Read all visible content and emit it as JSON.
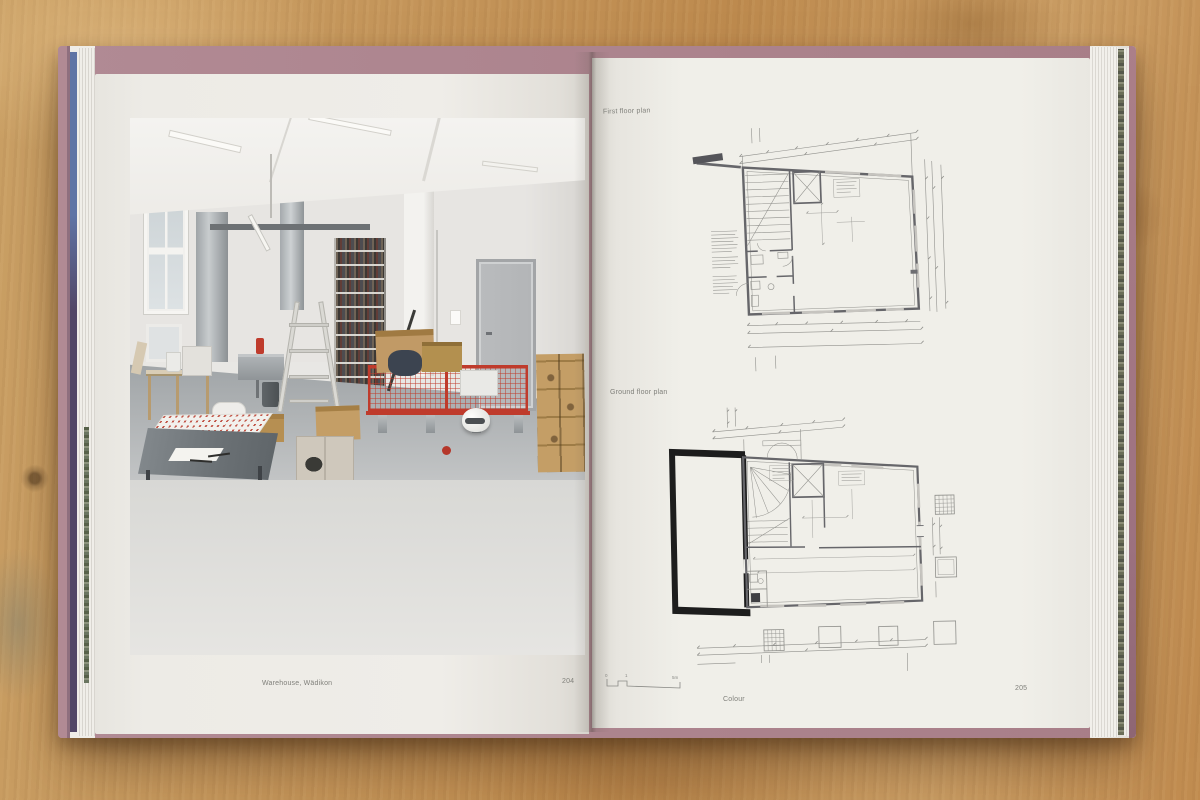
{
  "book": {
    "left_page": {
      "caption": "Warehouse, Wädikon",
      "page_number": "204"
    },
    "right_page": {
      "first_plan_label": "First floor plan",
      "ground_plan_label": "Ground floor plan",
      "footer_caption": "Colour",
      "page_number": "205",
      "scale_bar": {
        "tick_start": "0",
        "tick_mid": "1",
        "tick_end": "5m"
      }
    }
  },
  "colors": {
    "wood": "#c1924f",
    "wood_light": "#ddb87e",
    "wood_dark": "#8f6631",
    "cover": "#b18a94",
    "cover_dark": "#997683",
    "edge_blue": "#5f74a5",
    "edge_purple": "#524767",
    "page_left": "#edebe6",
    "page_right": "#f0efe9",
    "caption_text": "#80807b",
    "plan_line": "#90908c",
    "plan_wall": "#66666a",
    "plan_black": "#1d1d1d",
    "photo_wall": "#e7e5e2",
    "photo_ceiling": "#f4f3f0",
    "photo_floor": "#9ba0a3",
    "trolley_red": "#bf3b2c",
    "box_tan": "#c49e66",
    "door_gray": "#b3b5b7",
    "metal_gray": "#a9adb0"
  }
}
